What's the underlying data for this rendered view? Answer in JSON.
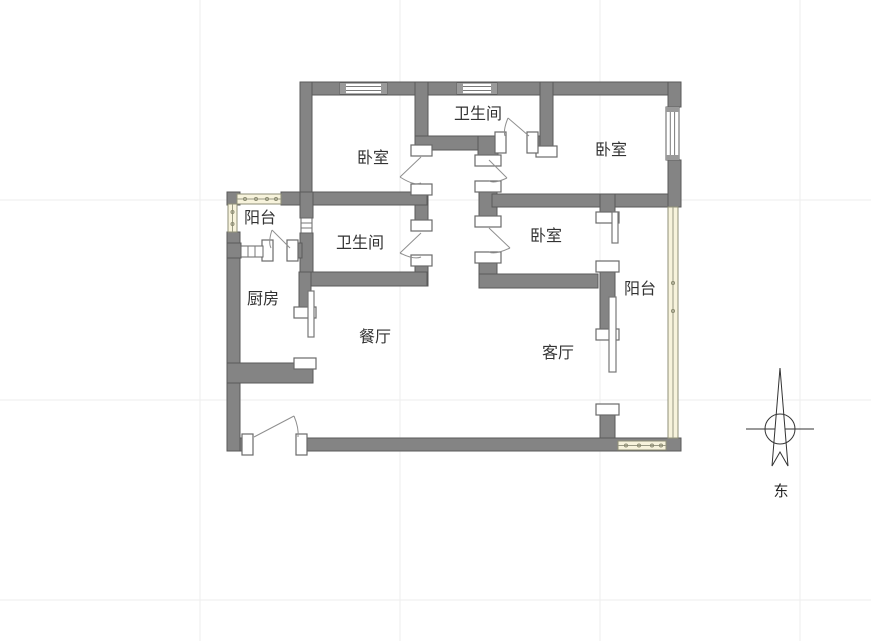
{
  "canvas": {
    "width": 871,
    "height": 641,
    "background": "#ffffff"
  },
  "rooms": [
    {
      "id": "bedroom-top-left",
      "label": "卧室"
    },
    {
      "id": "bathroom-top",
      "label": "卫生间"
    },
    {
      "id": "bedroom-top-right",
      "label": "卧室"
    },
    {
      "id": "balcony-left",
      "label": "阳台"
    },
    {
      "id": "bathroom-middle",
      "label": "卫生间"
    },
    {
      "id": "bedroom-middle",
      "label": "卧室"
    },
    {
      "id": "kitchen",
      "label": "厨房"
    },
    {
      "id": "dining-room",
      "label": "餐厅"
    },
    {
      "id": "living-room",
      "label": "客厅"
    },
    {
      "id": "balcony-right",
      "label": "阳台"
    }
  ],
  "compass": {
    "direction_label": "东"
  },
  "colors": {
    "wall": "#848484",
    "wall_outline": "#5a5a5a",
    "glass_window": "#f7f3dc",
    "grid_line": "#ededed",
    "label_text": "#333333"
  }
}
